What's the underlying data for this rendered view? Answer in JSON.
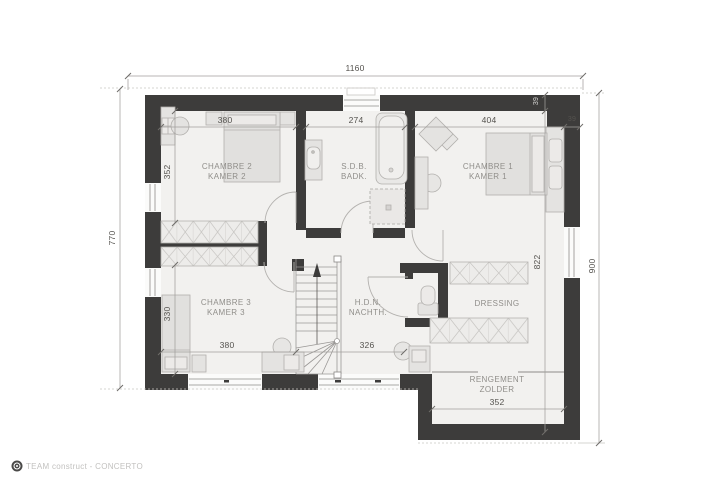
{
  "plan": {
    "rooms": {
      "chambre2": {
        "line1": "CHAMBRE 2",
        "line2": "KAMER 2"
      },
      "sdb": {
        "line1": "S.D.B.",
        "line2": "BADK."
      },
      "chambre1": {
        "line1": "CHAMBRE 1",
        "line2": "KAMER 1"
      },
      "chambre3": {
        "line1": "CHAMBRE 3",
        "line2": "KAMER 3"
      },
      "hall": {
        "line1": "H.D.N.",
        "line2": "NACHTH."
      },
      "dressing": {
        "line1": "DRESSING"
      },
      "zolder": {
        "line1": "RENGEMENT",
        "line2": "ZOLDER"
      }
    },
    "dimensions": {
      "overall_width": "1160",
      "left_height": "770",
      "right_height": "900",
      "right_interior": "822",
      "wall_top": "39",
      "wall_right": "39",
      "chambre2_width": "380",
      "chambre2_depth": "352",
      "sdb_width": "274",
      "chambre1_width": "404",
      "chambre3_width": "380",
      "chambre3_depth": "330",
      "hall_width": "326",
      "zolder_width": "352"
    },
    "colors": {
      "wall": "#3d3c3b",
      "floor": "#f2f1ef",
      "furniture": "#e4e3e1",
      "label_text": "#908e8a",
      "dim_text": "#55534f"
    }
  },
  "footer": {
    "credit": "TEAM construct - CONCERTO"
  }
}
